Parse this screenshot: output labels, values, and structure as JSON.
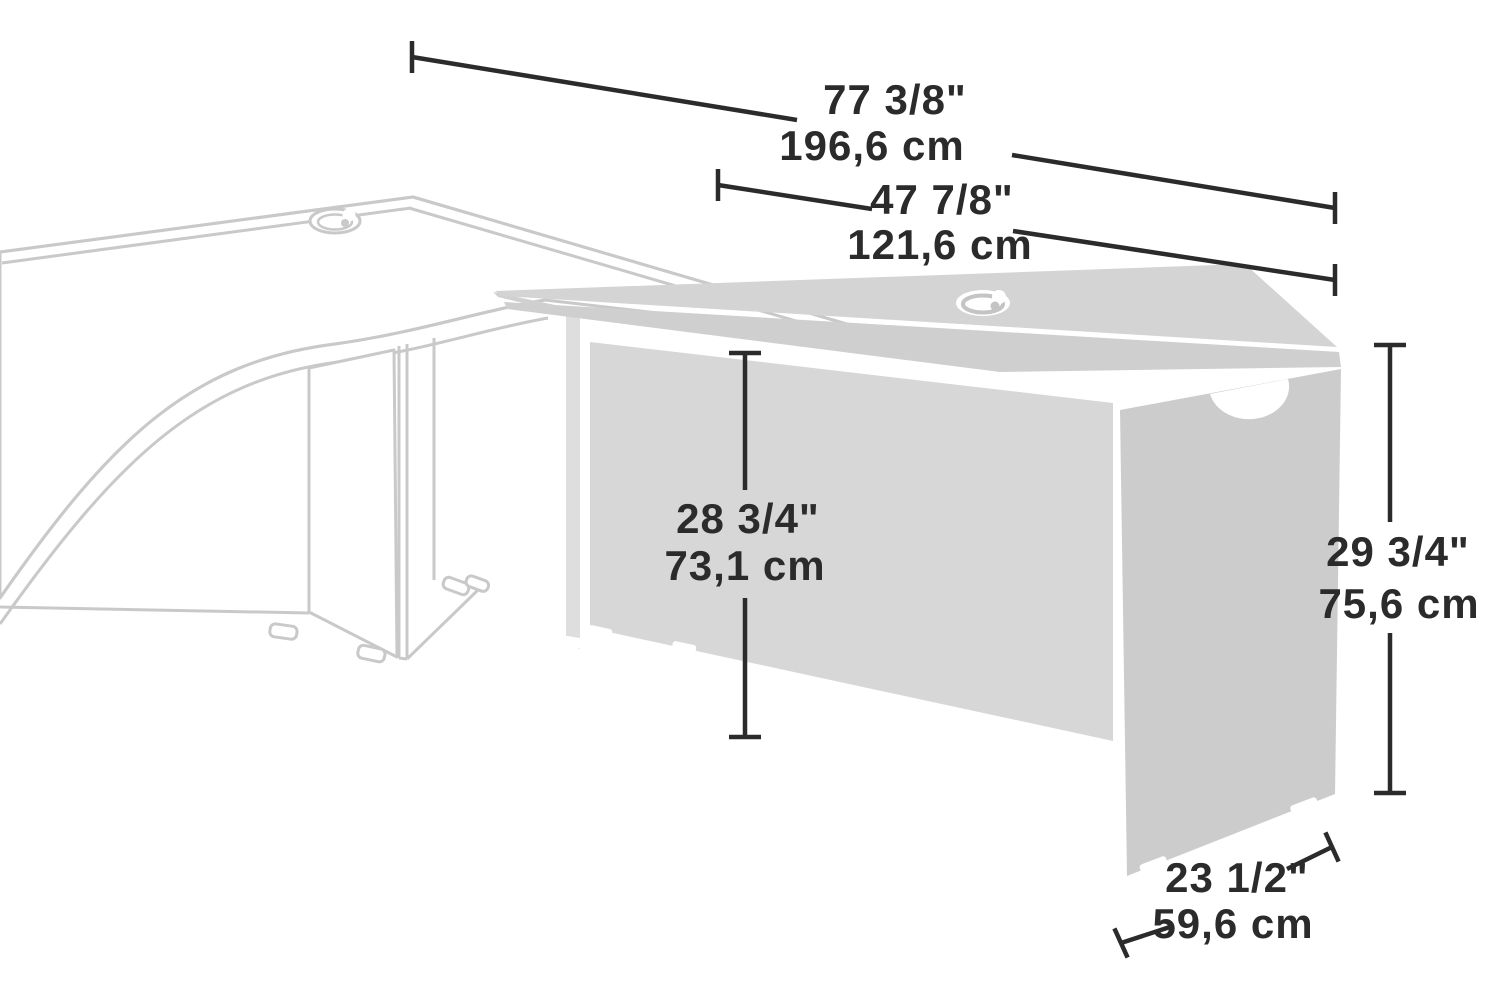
{
  "diagram": {
    "kind": "furniture-dimension-diagram",
    "colors": {
      "dimension_line": "#2b2b2b",
      "background_outline": "#c9c9c9",
      "unit_top_fill": "#d4d4d4",
      "unit_band_fill": "#cfcfcf",
      "unit_back_panel_fill": "#d7d7d7",
      "unit_right_panel_fill": "#cccccc",
      "unit_left_panel_fill": "#dedede",
      "background": "#ffffff"
    },
    "dimensions": {
      "overall_width": {
        "inches": "77 3/8\"",
        "metric": "196,6 cm"
      },
      "return_width": {
        "inches": "47 7/8\"",
        "metric": "121,6 cm"
      },
      "underside_height": {
        "inches": "28 3/4\"",
        "metric": "73,1 cm"
      },
      "overall_height": {
        "inches": "29 3/4\"",
        "metric": "75,6 cm"
      },
      "return_depth": {
        "inches": "23 1/2\"",
        "metric": "59,6 cm"
      }
    }
  }
}
